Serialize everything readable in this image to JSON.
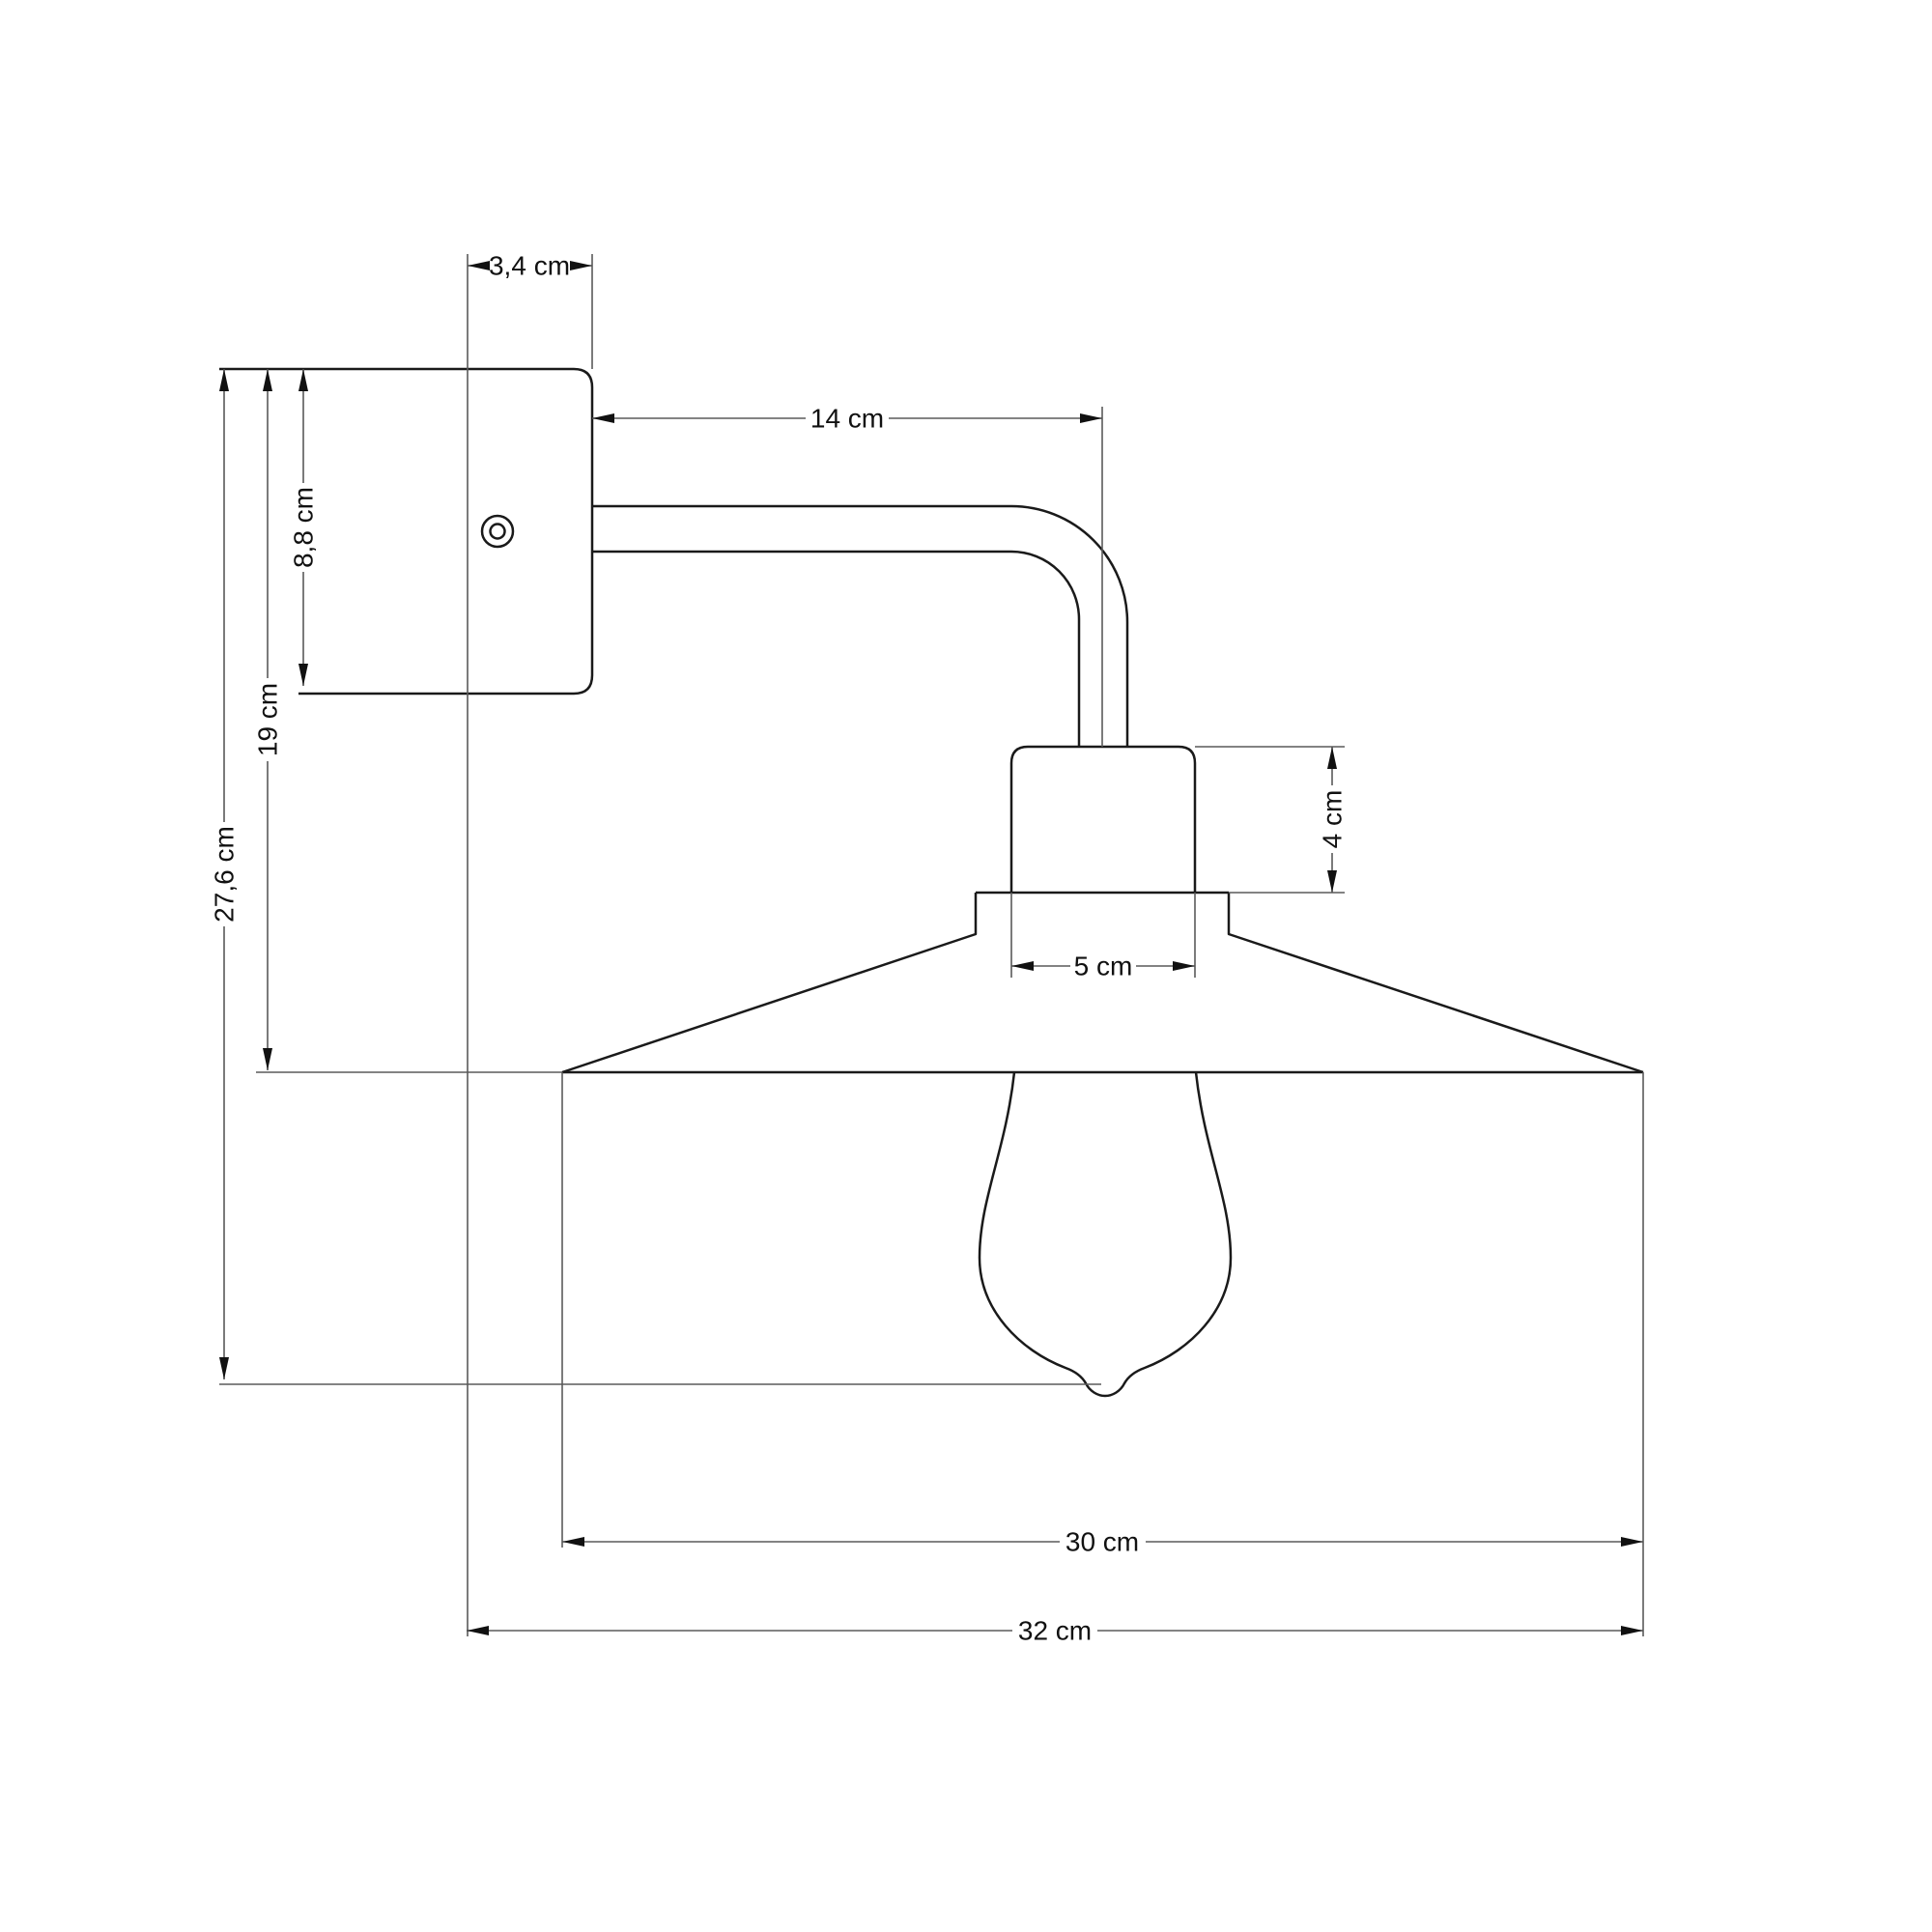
{
  "drawing": {
    "title": "Wall lamp with conical shade - dimensional side elevation",
    "unit": "cm",
    "colors": {
      "background": "#ffffff",
      "object_outline": "#1a1a1a",
      "dimension_lines": "#5a5a5a",
      "text": "#111111"
    },
    "parts": [
      "mounting-plate",
      "screw-hole",
      "curved-arm",
      "lamp-socket",
      "conical-lampshade",
      "light-bulb"
    ],
    "labels": {
      "plate_depth": "3,4 cm",
      "arm_length": "14 cm",
      "plate_height": "8,8 cm",
      "plate_to_shade": "19 cm",
      "total_height": "27,6 cm",
      "socket_height": "4 cm",
      "socket_width": "5 cm",
      "shade_diameter": "30 cm",
      "total_depth": "32 cm"
    }
  }
}
